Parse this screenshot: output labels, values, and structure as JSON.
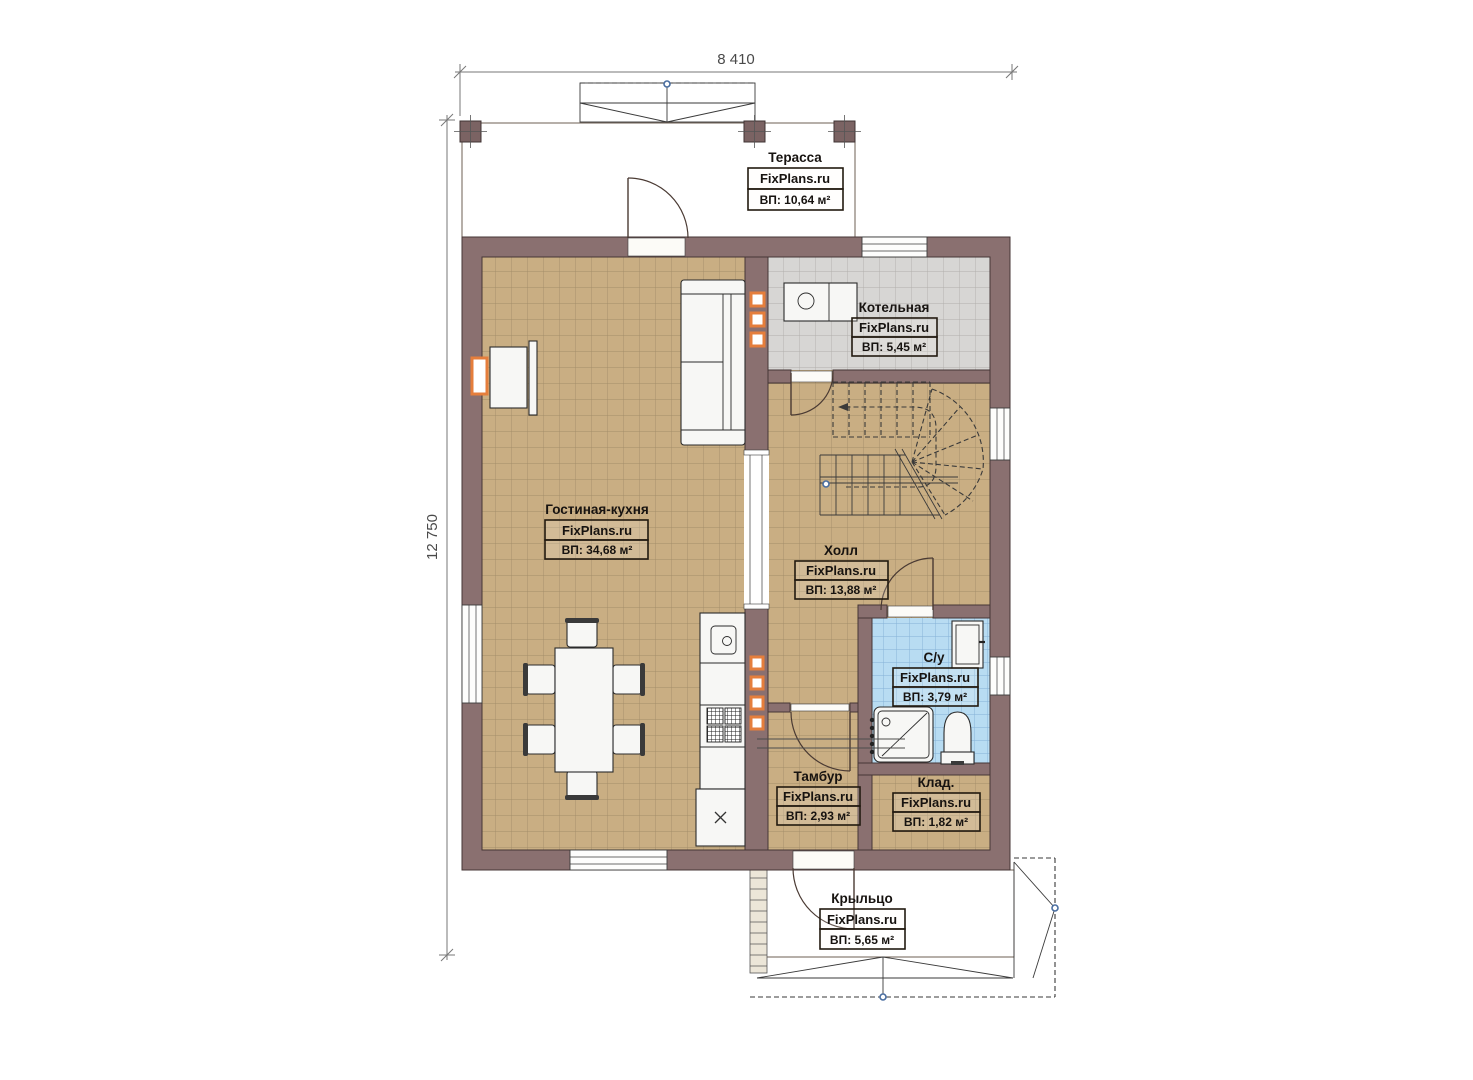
{
  "watermark": "FixPlans.ru",
  "dimensions": {
    "top": "8 410",
    "left": "12 750"
  },
  "rooms": [
    {
      "key": "terrace",
      "name": "Терасса",
      "area": "ВП: 10,64 м²"
    },
    {
      "key": "boiler",
      "name": "Котельная",
      "area": "ВП: 5,45 м²"
    },
    {
      "key": "living_kitchen",
      "name": "Гостиная-кухня",
      "area": "ВП: 34,68 м²"
    },
    {
      "key": "hall",
      "name": "Холл",
      "area": "ВП: 13,88 м²"
    },
    {
      "key": "bathroom",
      "name": "С/у",
      "area": "ВП: 3,79 м²"
    },
    {
      "key": "vestibule",
      "name": "Тамбур",
      "area": "ВП: 2,93 м²"
    },
    {
      "key": "storage",
      "name": "Клад.",
      "area": "ВП: 1,82 м²"
    },
    {
      "key": "porch",
      "name": "Крыльцо",
      "area": "ВП: 5,65 м²"
    }
  ],
  "colors": {
    "wall": "#8a7070",
    "floor_tan": "#c9ae83",
    "floor_gray": "#d7d6d4",
    "floor_blue": "#b8dcf2",
    "terrace_floor": "#ded3c0",
    "porch_floor": "#ddd0b8",
    "accent_orange": "#e57e3c",
    "marker_blue": "#4a6ea0"
  }
}
